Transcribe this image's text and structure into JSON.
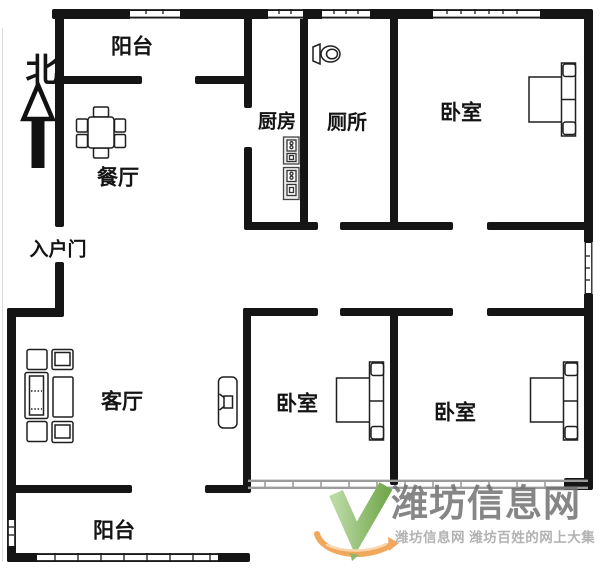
{
  "north": {
    "label": "北"
  },
  "rooms": {
    "balcony_top": "阳台",
    "dining": "餐厅",
    "kitchen": "厨房",
    "toilet": "厕所",
    "bedroom_top_right": "卧室",
    "entry": "入户门",
    "living": "客厅",
    "bedroom_bottom_middle": "卧室",
    "bedroom_bottom_right": "卧室",
    "balcony_bottom": "阳台"
  },
  "watermark": {
    "title": "潍坊信息网",
    "subtitle": "潍坊信息网 潍坊百姓的网上大集",
    "title_color": "#717171",
    "subtitle_color": "#b2b2b2",
    "logo_green": "#74a94f",
    "logo_orange": "#f2a85c"
  },
  "colors": {
    "wall": "#151515",
    "background": "#ffffff",
    "window_band": "#9c9c9c",
    "furniture_line": "#1f1f1f"
  }
}
